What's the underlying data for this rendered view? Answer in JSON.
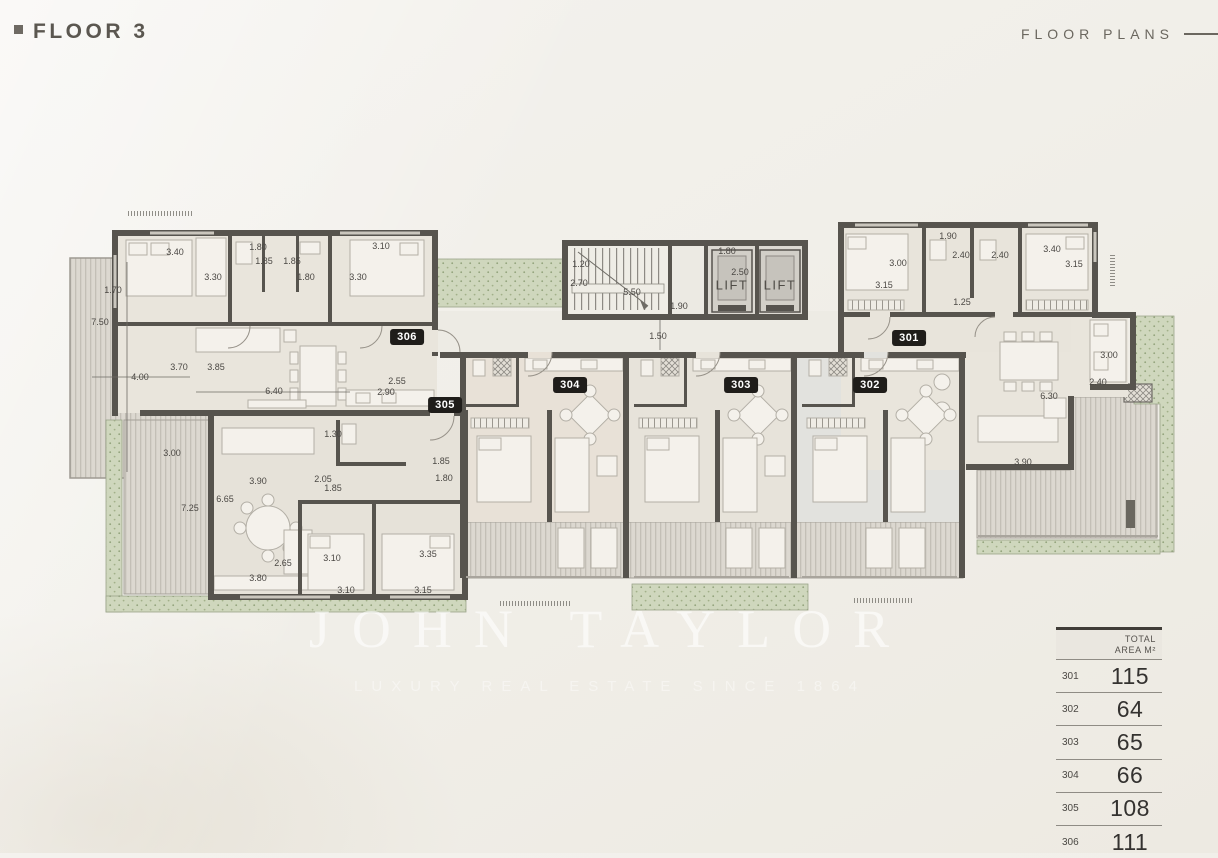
{
  "header": {
    "title": "FLOOR 3",
    "section_label": "FLOOR PLANS"
  },
  "watermark": {
    "brand": "JOHN TAYLOR",
    "tagline": "LUXURY REAL ESTATE SINCE 1864"
  },
  "plan": {
    "lift_label": "LIFT",
    "lifts": [
      {
        "x": 732,
        "y": 285
      },
      {
        "x": 780,
        "y": 285
      }
    ],
    "badges": [
      {
        "id": "301",
        "x": 909,
        "y": 338
      },
      {
        "id": "302",
        "x": 870,
        "y": 385
      },
      {
        "id": "303",
        "x": 741,
        "y": 385
      },
      {
        "id": "304",
        "x": 570,
        "y": 385
      },
      {
        "id": "305",
        "x": 445,
        "y": 405
      },
      {
        "id": "306",
        "x": 407,
        "y": 337
      }
    ],
    "dimensions": [
      {
        "t": "3.40",
        "x": 175,
        "y": 252
      },
      {
        "t": "1.80",
        "x": 258,
        "y": 247
      },
      {
        "t": "1.85",
        "x": 264,
        "y": 261
      },
      {
        "t": "1.85",
        "x": 292,
        "y": 261
      },
      {
        "t": "3.10",
        "x": 381,
        "y": 246
      },
      {
        "t": "1.70",
        "x": 113,
        "y": 290
      },
      {
        "t": "3.30",
        "x": 213,
        "y": 277
      },
      {
        "t": "1.80",
        "x": 306,
        "y": 277
      },
      {
        "t": "3.30",
        "x": 358,
        "y": 277
      },
      {
        "t": "7.50",
        "x": 100,
        "y": 322
      },
      {
        "t": "3.70",
        "x": 179,
        "y": 367
      },
      {
        "t": "3.85",
        "x": 216,
        "y": 367
      },
      {
        "t": "4.00",
        "x": 140,
        "y": 377
      },
      {
        "t": "6.40",
        "x": 274,
        "y": 391
      },
      {
        "t": "2.55",
        "x": 397,
        "y": 381
      },
      {
        "t": "2.90",
        "x": 386,
        "y": 392
      },
      {
        "t": "1.20",
        "x": 581,
        "y": 264
      },
      {
        "t": "2.70",
        "x": 579,
        "y": 283
      },
      {
        "t": "5.50",
        "x": 632,
        "y": 292
      },
      {
        "t": "1.80",
        "x": 727,
        "y": 251
      },
      {
        "t": "2.50",
        "x": 740,
        "y": 272
      },
      {
        "t": "1.90",
        "x": 679,
        "y": 306
      },
      {
        "t": "1.50",
        "x": 658,
        "y": 336
      },
      {
        "t": "1.90",
        "x": 948,
        "y": 236
      },
      {
        "t": "3.00",
        "x": 898,
        "y": 263
      },
      {
        "t": "2.40",
        "x": 961,
        "y": 255
      },
      {
        "t": "2.40",
        "x": 1000,
        "y": 255
      },
      {
        "t": "3.40",
        "x": 1052,
        "y": 249
      },
      {
        "t": "3.15",
        "x": 1074,
        "y": 264
      },
      {
        "t": "3.15",
        "x": 884,
        "y": 285
      },
      {
        "t": "1.25",
        "x": 962,
        "y": 302
      },
      {
        "t": "3.00",
        "x": 1109,
        "y": 355
      },
      {
        "t": "2.40",
        "x": 1098,
        "y": 382
      },
      {
        "t": "6.30",
        "x": 1049,
        "y": 396
      },
      {
        "t": "3.90",
        "x": 1023,
        "y": 462
      },
      {
        "t": "1.30",
        "x": 333,
        "y": 434
      },
      {
        "t": "3.00",
        "x": 172,
        "y": 453
      },
      {
        "t": "3.90",
        "x": 258,
        "y": 481
      },
      {
        "t": "6.65",
        "x": 225,
        "y": 499
      },
      {
        "t": "2.05",
        "x": 323,
        "y": 479
      },
      {
        "t": "1.85",
        "x": 333,
        "y": 488
      },
      {
        "t": "1.85",
        "x": 441,
        "y": 461
      },
      {
        "t": "1.80",
        "x": 444,
        "y": 478
      },
      {
        "t": "7.25",
        "x": 190,
        "y": 508
      },
      {
        "t": "2.65",
        "x": 283,
        "y": 563
      },
      {
        "t": "3.80",
        "x": 258,
        "y": 578
      },
      {
        "t": "3.10",
        "x": 332,
        "y": 558
      },
      {
        "t": "3.35",
        "x": 428,
        "y": 554
      },
      {
        "t": "3.10",
        "x": 346,
        "y": 590
      },
      {
        "t": "3.15",
        "x": 423,
        "y": 590
      }
    ]
  },
  "area_table": {
    "header_line1": "TOTAL",
    "header_line2": "AREA M²",
    "rows": [
      {
        "unit": "301",
        "area": "115"
      },
      {
        "unit": "302",
        "area": "64"
      },
      {
        "unit": "303",
        "area": "65"
      },
      {
        "unit": "304",
        "area": "66"
      },
      {
        "unit": "305",
        "area": "108"
      },
      {
        "unit": "306",
        "area": "111"
      }
    ]
  }
}
